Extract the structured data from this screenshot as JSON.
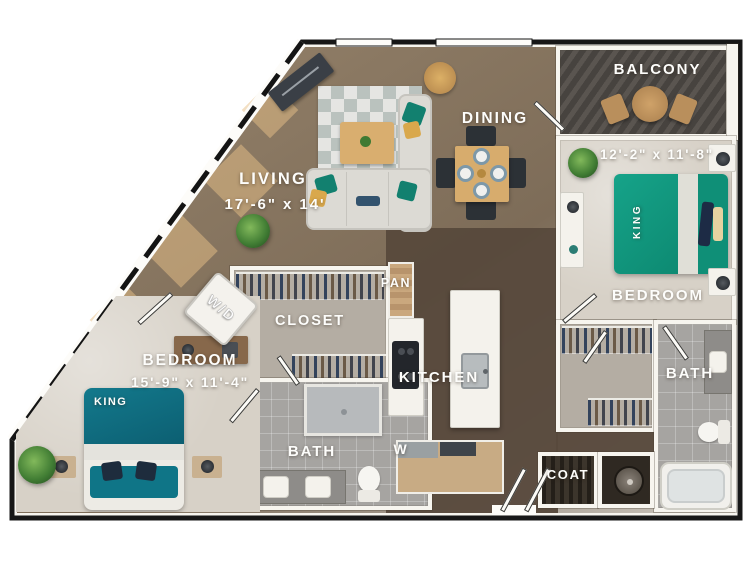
{
  "floorplan": {
    "labels": {
      "balcony": "BALCONY",
      "dining": "DINING",
      "living": "LIVING",
      "living_dims": "17'-6\" x 14'",
      "bedroom2": "BEDROOM",
      "bedroom2_dims": "12'-2\" x 11'-8\"",
      "bedroom2_bed": "KING",
      "closet": "CLOSET",
      "pantry": "PAN",
      "kitchen": "KITCHEN",
      "washer_letter": "W",
      "laundry": "W/D",
      "bedroom1": "BEDROOM",
      "bedroom1_dims": "15'-9\" x 11'-4\"",
      "bedroom1_bed": "KING",
      "bath1": "BATH",
      "bath2": "BATH",
      "coat": "COAT"
    },
    "colors": {
      "wood_light": "#93816a",
      "wood_dark": "#5a4d40",
      "carpet": "#d7d1c7",
      "tile": "#a6a4a1",
      "bed_teal_green": "#119a80",
      "bed_teal_blue": "#0e6e80",
      "pillow_mustard": "#d9a84c",
      "wall_white": "#f7f5ef",
      "outline_black": "#171717",
      "balcony_gray": "#4c4946"
    }
  }
}
